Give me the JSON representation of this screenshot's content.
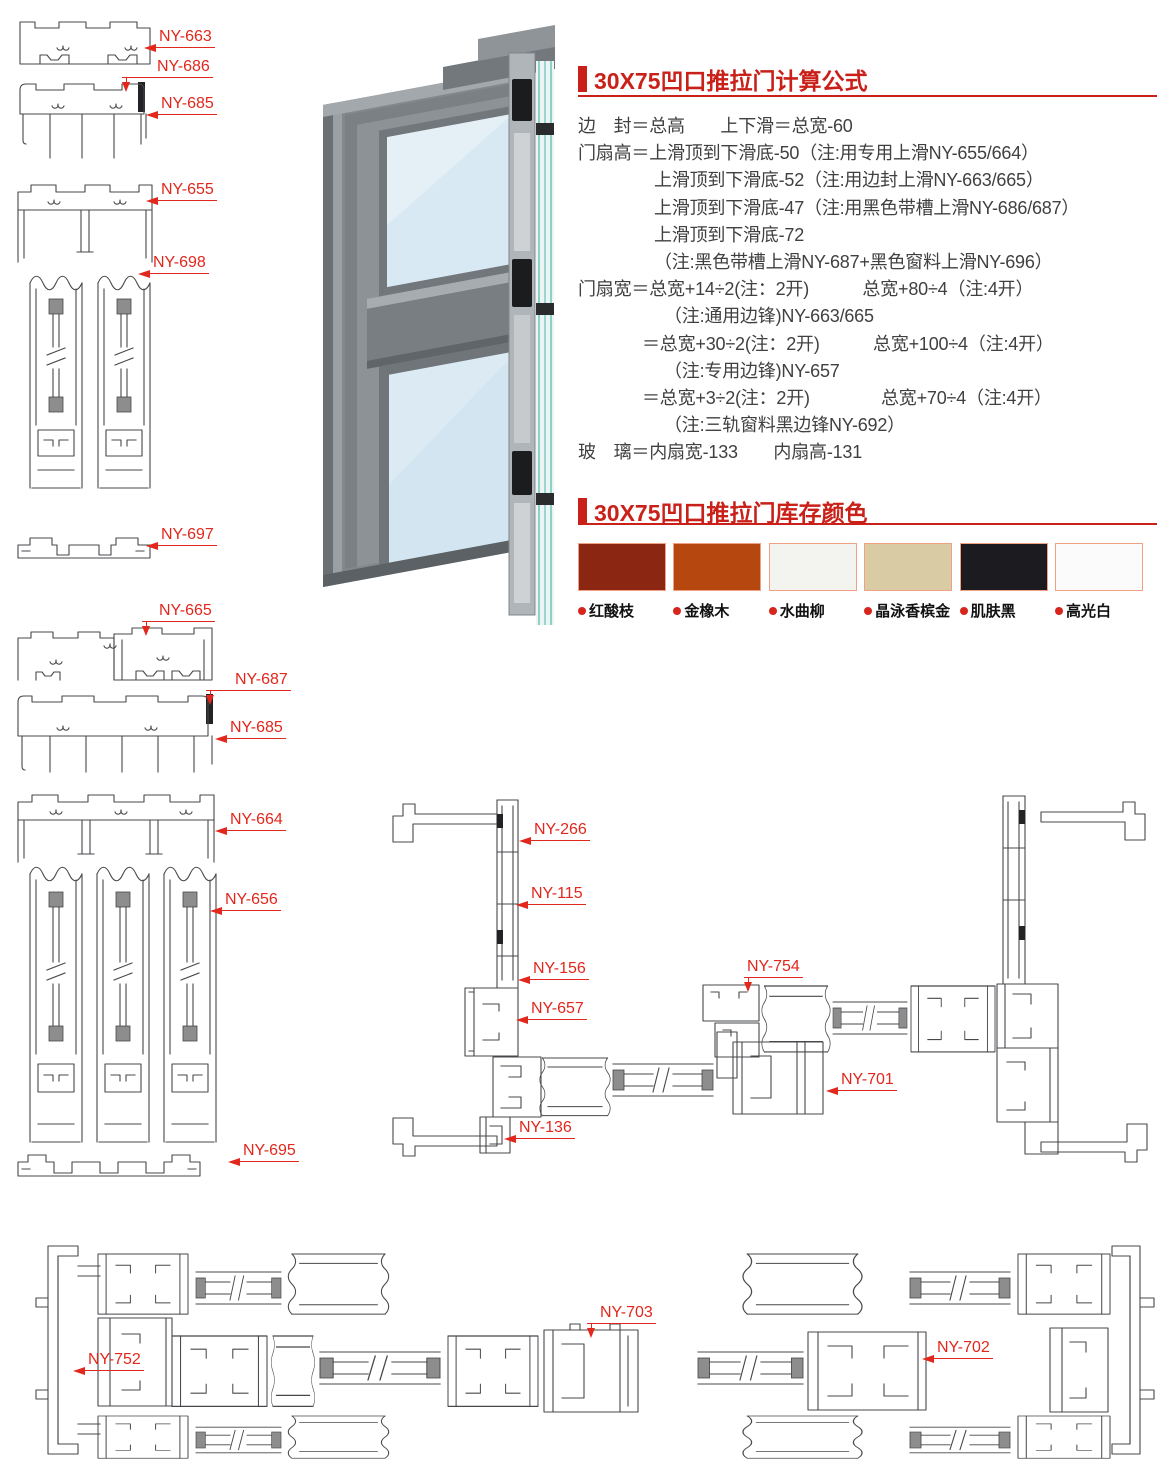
{
  "colors": {
    "accent_red": "#c9211a",
    "callout_red": "#e2271c",
    "line_gray": "#47484b"
  },
  "sections": {
    "formula": {
      "title": "30X75凹口推拉门计算公式",
      "lines": [
        {
          "indent": 0,
          "text": "边　封＝总高　　上下滑＝总宽-60"
        },
        {
          "indent": 0,
          "text": "门扇高＝上滑顶到下滑底-50（注:用专用上滑NY-655/664）"
        },
        {
          "indent": 76,
          "text": "上滑顶到下滑底-52（注:用边封上滑NY-663/665）"
        },
        {
          "indent": 76,
          "text": "上滑顶到下滑底-47（注:用黑色带槽上滑NY-686/687）"
        },
        {
          "indent": 76,
          "text": "上滑顶到下滑底-72"
        },
        {
          "indent": 76,
          "text": "（注:黑色带槽上滑NY-687+黑色窗料上滑NY-696）"
        },
        {
          "indent": 0,
          "text": "门扇宽＝总宽+14÷2(注：2开)　　　总宽+80÷4（注:4开）"
        },
        {
          "indent": 86,
          "text": "（注:通用边锋)NY-663/665"
        },
        {
          "indent": 64,
          "text": "＝总宽+30÷2(注：2开)　　　总宽+100÷4（注:4开）"
        },
        {
          "indent": 86,
          "text": "（注:专用边锋)NY-657"
        },
        {
          "indent": 64,
          "text": "＝总宽+3÷2(注：2开)　　　　总宽+70÷4（注:4开）"
        },
        {
          "indent": 86,
          "text": "（注:三轨窗料黑边锋NY-692）"
        },
        {
          "indent": 0,
          "text": "玻　璃＝内扇宽-133　　内扇高-131"
        }
      ]
    },
    "stock_colors": {
      "title": "30X75凹口推拉门库存颜色",
      "swatches": [
        {
          "label": "红酸枝",
          "css": "sw-rosewood",
          "color": "#8a2612"
        },
        {
          "label": "金橡木",
          "css": "sw-oak",
          "color": "#b5470f"
        },
        {
          "label": "水曲柳",
          "css": "sw-ash",
          "color": "#f3f3f0"
        },
        {
          "label": "晶泳香槟金",
          "css": "sw-champagne",
          "color": "#d9cca5"
        },
        {
          "label": "肌肤黑",
          "css": "sw-black",
          "color": "#1c1c20"
        },
        {
          "label": "高光白",
          "css": "sw-white",
          "color": "#fbfbfb"
        }
      ]
    }
  },
  "callouts": {
    "ny663": "NY-663",
    "ny686": "NY-686",
    "ny685a": "NY-685",
    "ny655": "NY-655",
    "ny698": "NY-698",
    "ny697": "NY-697",
    "ny665": "NY-665",
    "ny687": "NY-687",
    "ny685b": "NY-685",
    "ny664": "NY-664",
    "ny656": "NY-656",
    "ny695": "NY-695",
    "ny266": "NY-266",
    "ny115": "NY-115",
    "ny156": "NY-156",
    "ny657": "NY-657",
    "ny754": "NY-754",
    "ny701": "NY-701",
    "ny136": "NY-136",
    "ny752": "NY-752",
    "ny703": "NY-703",
    "ny702": "NY-702"
  }
}
